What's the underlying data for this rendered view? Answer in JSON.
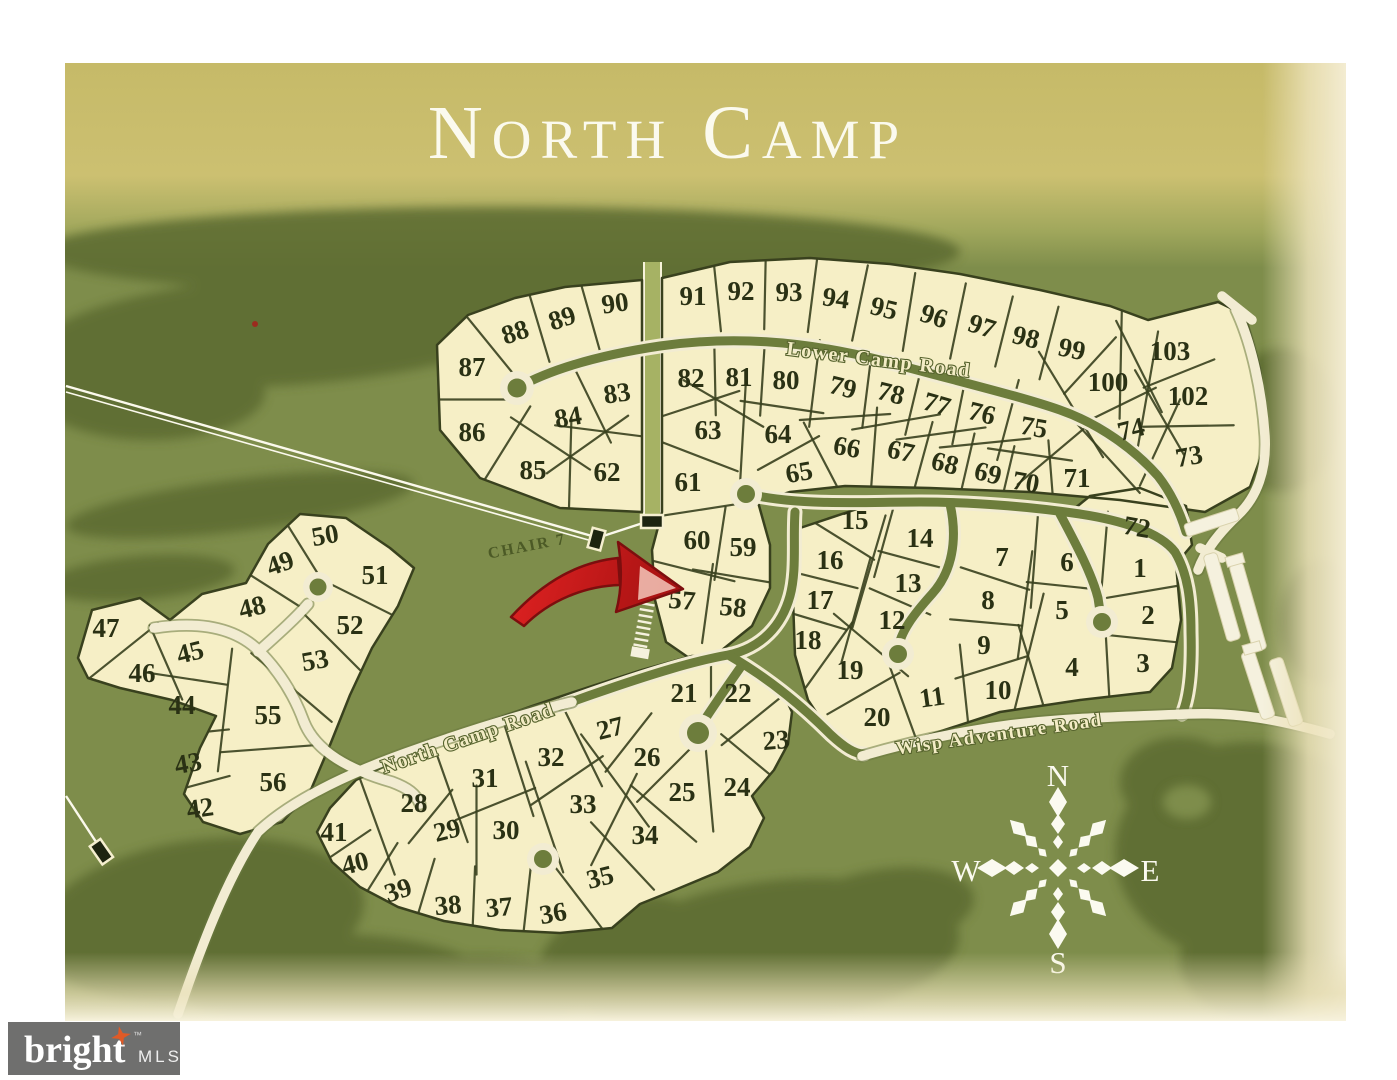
{
  "title": "NORTH CAMP",
  "map": {
    "roads": [
      {
        "name": "Lower Camp Road"
      },
      {
        "name": "North Camp Road"
      },
      {
        "name": "Wisp Adventure Road"
      }
    ],
    "chair_lift_label": "CHAIR 7",
    "highlight_arrow": {
      "points_to_lot": "57",
      "color": "#c41c1c"
    },
    "compass": {
      "north": "N",
      "east": "E",
      "south": "S",
      "west": "W"
    },
    "lots": [
      [
        86,
        472,
        432,
        0
      ],
      [
        87,
        472,
        367,
        0
      ],
      [
        88,
        515,
        332,
        -18
      ],
      [
        89,
        562,
        318,
        -18
      ],
      [
        90,
        615,
        303,
        -8
      ],
      [
        85,
        533,
        470,
        0
      ],
      [
        84,
        568,
        417,
        -10
      ],
      [
        83,
        617,
        393,
        -8
      ],
      [
        62,
        607,
        472,
        0
      ],
      [
        91,
        693,
        296,
        0
      ],
      [
        92,
        741,
        291,
        0
      ],
      [
        93,
        789,
        292,
        0
      ],
      [
        94,
        836,
        298,
        8
      ],
      [
        95,
        884,
        308,
        14
      ],
      [
        96,
        934,
        316,
        18
      ],
      [
        97,
        982,
        326,
        18
      ],
      [
        98,
        1026,
        337,
        14
      ],
      [
        99,
        1072,
        349,
        12
      ],
      [
        100,
        1108,
        382,
        0
      ],
      [
        103,
        1170,
        351,
        0
      ],
      [
        102,
        1188,
        396,
        0
      ],
      [
        82,
        691,
        378,
        0
      ],
      [
        81,
        739,
        377,
        0
      ],
      [
        80,
        786,
        380,
        0
      ],
      [
        79,
        843,
        387,
        14
      ],
      [
        78,
        891,
        393,
        14
      ],
      [
        77,
        937,
        404,
        16
      ],
      [
        76,
        982,
        413,
        14
      ],
      [
        75,
        1034,
        427,
        10
      ],
      [
        74,
        1131,
        429,
        -14
      ],
      [
        73,
        1189,
        456,
        -10
      ],
      [
        63,
        708,
        430,
        0
      ],
      [
        64,
        778,
        434,
        0
      ],
      [
        65,
        799,
        472,
        -10
      ],
      [
        66,
        847,
        447,
        10
      ],
      [
        67,
        901,
        451,
        12
      ],
      [
        68,
        945,
        463,
        14
      ],
      [
        69,
        988,
        473,
        14
      ],
      [
        70,
        1026,
        482,
        10
      ],
      [
        71,
        1077,
        478,
        0
      ],
      [
        61,
        688,
        482,
        0
      ],
      [
        60,
        697,
        540,
        0
      ],
      [
        59,
        743,
        547,
        0
      ],
      [
        57,
        682,
        600,
        5
      ],
      [
        58,
        733,
        607,
        5
      ],
      [
        72,
        1137,
        527,
        10
      ],
      [
        15,
        855,
        520,
        0
      ],
      [
        14,
        920,
        538,
        0
      ],
      [
        16,
        830,
        560,
        0
      ],
      [
        13,
        908,
        583,
        0
      ],
      [
        7,
        1002,
        557,
        0
      ],
      [
        6,
        1067,
        562,
        0
      ],
      [
        1,
        1140,
        568,
        0
      ],
      [
        17,
        820,
        600,
        0
      ],
      [
        12,
        892,
        620,
        0
      ],
      [
        8,
        988,
        600,
        0
      ],
      [
        5,
        1062,
        610,
        0
      ],
      [
        2,
        1148,
        615,
        0
      ],
      [
        18,
        808,
        640,
        0
      ],
      [
        9,
        984,
        645,
        0
      ],
      [
        4,
        1072,
        667,
        0
      ],
      [
        3,
        1143,
        663,
        0
      ],
      [
        19,
        850,
        670,
        0
      ],
      [
        11,
        932,
        697,
        -8
      ],
      [
        10,
        998,
        690,
        0
      ],
      [
        20,
        877,
        717,
        0
      ],
      [
        47,
        106,
        628,
        0
      ],
      [
        50,
        325,
        535,
        -10
      ],
      [
        49,
        280,
        563,
        -20
      ],
      [
        48,
        252,
        607,
        -14
      ],
      [
        51,
        375,
        575,
        0
      ],
      [
        45,
        190,
        652,
        -14
      ],
      [
        46,
        142,
        673,
        0
      ],
      [
        52,
        350,
        625,
        0
      ],
      [
        53,
        315,
        660,
        -10
      ],
      [
        44,
        182,
        705,
        0
      ],
      [
        55,
        268,
        715,
        0
      ],
      [
        43,
        188,
        763,
        -10
      ],
      [
        56,
        273,
        782,
        0
      ],
      [
        42,
        200,
        808,
        -8
      ],
      [
        41,
        334,
        832,
        0
      ],
      [
        40,
        355,
        863,
        -14
      ],
      [
        39,
        398,
        890,
        -18
      ],
      [
        38,
        448,
        905,
        -5
      ],
      [
        37,
        499,
        907,
        -5
      ],
      [
        36,
        553,
        913,
        -10
      ],
      [
        35,
        600,
        877,
        -14
      ],
      [
        34,
        645,
        835,
        0
      ],
      [
        33,
        583,
        804,
        0
      ],
      [
        30,
        506,
        830,
        0
      ],
      [
        29,
        447,
        830,
        -14
      ],
      [
        28,
        414,
        803,
        0
      ],
      [
        31,
        485,
        778,
        0
      ],
      [
        32,
        551,
        757,
        0
      ],
      [
        27,
        610,
        728,
        -14
      ],
      [
        26,
        647,
        757,
        0
      ],
      [
        25,
        682,
        792,
        0
      ],
      [
        24,
        737,
        787,
        0
      ],
      [
        23,
        776,
        740,
        -5
      ],
      [
        22,
        738,
        693,
        0
      ],
      [
        21,
        684,
        693,
        0
      ]
    ],
    "clusters": [
      {
        "id": "A",
        "points": "437,345 468,315 515,298 565,287 642,280 642,512 560,508 480,478 440,430"
      },
      {
        "id": "B",
        "points": "662,278 730,262 810,258 890,264 960,274 1040,290 1110,306 1148,320 1218,302 1245,315 1260,368 1268,437 1250,487 1205,512 1120,500 1030,492 930,488 845,486 790,492 758,502 770,545 770,588 752,626 722,650 692,660 666,642 655,600 652,550 662,512"
      },
      {
        "id": "C",
        "points": "800,528 860,508 930,504 1010,510 1064,517 1090,496 1140,488 1186,506 1192,545 1176,564 1181,620 1172,668 1150,692 1080,700 1000,712 920,738 866,752 832,736 808,700 795,655 793,600 797,558"
      },
      {
        "id": "D",
        "points": "78,658 92,610 140,598 170,620 202,594 246,583 268,544 300,514 346,518 390,548 414,568 398,606 372,648 350,695 330,745 310,792 282,822 240,834 203,822 184,794 200,748 216,716 172,700 120,688 88,678"
      },
      {
        "id": "E",
        "points": "330,808 356,780 410,754 470,728 532,706 592,686 642,670 692,656 742,658 777,680 792,712 788,744 774,770 752,796 764,818 750,847 718,872 670,892 640,904 612,928 560,933 500,930 444,921 398,907 360,887 332,862 317,832"
      }
    ],
    "boundaries": [
      [
        "86",
        "87",
        "A"
      ],
      [
        "87",
        "88",
        "A"
      ],
      [
        "88",
        "89",
        "A"
      ],
      [
        "89",
        "90",
        "A"
      ],
      [
        "85",
        "86",
        "A"
      ],
      [
        "85",
        "84",
        "A"
      ],
      [
        "84",
        "83",
        "A"
      ],
      [
        "62",
        "83",
        "A"
      ],
      [
        "85",
        "62",
        "A"
      ],
      [
        "84",
        "62",
        "A"
      ],
      [
        "91",
        "92",
        "B"
      ],
      [
        "92",
        "93",
        "B"
      ],
      [
        "93",
        "94",
        "B"
      ],
      [
        "94",
        "95",
        "B"
      ],
      [
        "95",
        "96",
        "B"
      ],
      [
        "96",
        "97",
        "B"
      ],
      [
        "97",
        "98",
        "B"
      ],
      [
        "98",
        "99",
        "B"
      ],
      [
        "99",
        "103",
        "B"
      ],
      [
        "99",
        "100",
        "B"
      ],
      [
        "100",
        "103",
        "B"
      ],
      [
        "100",
        "102",
        "B"
      ],
      [
        "102",
        "103",
        "B"
      ],
      [
        "82",
        "81",
        "B"
      ],
      [
        "81",
        "80",
        "B"
      ],
      [
        "80",
        "79",
        "B"
      ],
      [
        "79",
        "78",
        "B"
      ],
      [
        "78",
        "77",
        "B"
      ],
      [
        "77",
        "76",
        "B"
      ],
      [
        "76",
        "75",
        "B"
      ],
      [
        "75",
        "100",
        "B"
      ],
      [
        "100",
        "74",
        "B"
      ],
      [
        "102",
        "74",
        "B"
      ],
      [
        "74",
        "73",
        "B"
      ],
      [
        "102",
        "73",
        "B"
      ],
      [
        "63",
        "64",
        "B"
      ],
      [
        "64",
        "65",
        "B"
      ],
      [
        "66",
        "67",
        "B"
      ],
      [
        "67",
        "68",
        "B"
      ],
      [
        "68",
        "69",
        "B"
      ],
      [
        "69",
        "70",
        "B"
      ],
      [
        "70",
        "71",
        "B"
      ],
      [
        "71",
        "74",
        "B"
      ],
      [
        "82",
        "63",
        "B"
      ],
      [
        "81",
        "63",
        "B"
      ],
      [
        "80",
        "64",
        "B"
      ],
      [
        "79",
        "66",
        "B"
      ],
      [
        "78",
        "67",
        "B"
      ],
      [
        "77",
        "68",
        "B"
      ],
      [
        "76",
        "69",
        "B"
      ],
      [
        "75",
        "70",
        "B"
      ],
      [
        "75",
        "71",
        "B"
      ],
      [
        "65",
        "66",
        "B"
      ],
      [
        "61",
        "63",
        "B"
      ],
      [
        "61",
        "60",
        "B"
      ],
      [
        "60",
        "59",
        "B"
      ],
      [
        "59",
        "58",
        "B"
      ],
      [
        "57",
        "58",
        "B"
      ],
      [
        "57",
        "60",
        "B"
      ],
      [
        "15",
        "14",
        "C"
      ],
      [
        "15",
        "16",
        "C"
      ],
      [
        "16",
        "13",
        "C"
      ],
      [
        "14",
        "13",
        "C"
      ],
      [
        "16",
        "17",
        "C"
      ],
      [
        "17",
        "12",
        "C"
      ],
      [
        "13",
        "12",
        "C"
      ],
      [
        "17",
        "18",
        "C"
      ],
      [
        "18",
        "19",
        "C"
      ],
      [
        "12",
        "19",
        "C"
      ],
      [
        "19",
        "20",
        "C"
      ],
      [
        "20",
        "11",
        "C"
      ],
      [
        "11",
        "10",
        "C"
      ],
      [
        "10",
        "9",
        "C"
      ],
      [
        "9",
        "8",
        "C"
      ],
      [
        "8",
        "7",
        "C"
      ],
      [
        "7",
        "6",
        "C"
      ],
      [
        "6",
        "5",
        "C"
      ],
      [
        "5",
        "8",
        "C"
      ],
      [
        "9",
        "4",
        "C"
      ],
      [
        "4",
        "3",
        "C"
      ],
      [
        "3",
        "2",
        "C"
      ],
      [
        "2",
        "1",
        "C"
      ],
      [
        "1",
        "6",
        "C"
      ],
      [
        "4",
        "10",
        "C"
      ],
      [
        "47",
        "46",
        "D"
      ],
      [
        "46",
        "45",
        "D"
      ],
      [
        "45",
        "44",
        "D"
      ],
      [
        "44",
        "43",
        "D"
      ],
      [
        "43",
        "42",
        "D"
      ],
      [
        "48",
        "49",
        "D"
      ],
      [
        "49",
        "50",
        "D"
      ],
      [
        "51",
        "52",
        "D"
      ],
      [
        "52",
        "53",
        "D"
      ],
      [
        "53",
        "55",
        "D"
      ],
      [
        "55",
        "56",
        "D"
      ],
      [
        "44",
        "55",
        "D"
      ],
      [
        "21",
        "22",
        "E"
      ],
      [
        "22",
        "23",
        "E"
      ],
      [
        "23",
        "24",
        "E"
      ],
      [
        "24",
        "25",
        "E"
      ],
      [
        "25",
        "26",
        "E"
      ],
      [
        "26",
        "27",
        "E"
      ],
      [
        "26",
        "33",
        "E"
      ],
      [
        "27",
        "32",
        "E"
      ],
      [
        "32",
        "33",
        "E"
      ],
      [
        "32",
        "31",
        "E"
      ],
      [
        "31",
        "28",
        "E"
      ],
      [
        "28",
        "29",
        "E"
      ],
      [
        "29",
        "30",
        "E"
      ],
      [
        "30",
        "31",
        "E"
      ],
      [
        "33",
        "34",
        "E"
      ],
      [
        "34",
        "35",
        "E"
      ],
      [
        "35",
        "36",
        "E"
      ],
      [
        "36",
        "37",
        "E"
      ],
      [
        "37",
        "38",
        "E"
      ],
      [
        "38",
        "39",
        "E"
      ],
      [
        "39",
        "40",
        "E"
      ],
      [
        "40",
        "41",
        "E"
      ],
      [
        "41",
        "28",
        "E"
      ],
      [
        "25",
        "34",
        "E"
      ],
      [
        "33",
        "30",
        "E"
      ]
    ],
    "colors": {
      "page": "#ffffff",
      "banner_gold": "#c9bd6c",
      "grass": "#7e8d4b",
      "forest": "#5d6c33",
      "lot_fill": "#f6efc6",
      "lot_outline": "#39411e",
      "road_cream": "#f2ecd2",
      "road_core": "#6d7d3c",
      "arrow_red": "#c41c1c",
      "title_white": "#fbfaee",
      "logo_gray": "#6f6f6e",
      "logo_orange": "#e05a26"
    }
  },
  "logo": {
    "brand": "bright",
    "tm": "™",
    "suffix": "MLS"
  }
}
